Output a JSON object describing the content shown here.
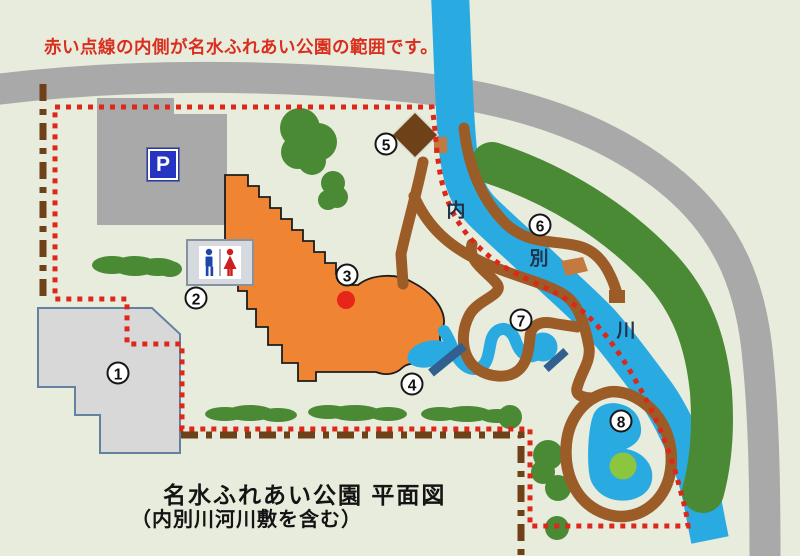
{
  "notice": "赤い点線の内側が名水ふれあい公園の範囲です。",
  "title": {
    "line1": "名水ふれあい公園 平面図",
    "line2": "（内別川河川敷を含む）"
  },
  "parking": {
    "label": "P"
  },
  "river_labels": [
    "内",
    "別",
    "川"
  ],
  "markers": [
    "1",
    "2",
    "3",
    "4",
    "5",
    "6",
    "7",
    "8"
  ],
  "icons": {
    "parking": "parking-sign-icon",
    "toilet_man": "man-icon",
    "toilet_woman": "woman-icon"
  },
  "colors": {
    "background": "#e8ecdd",
    "road_gray": "#a9a9a9",
    "river_blue": "#29abe2",
    "path_brown": "#9c5c28",
    "dock_brown": "#c4793f",
    "diamond_brown": "#6f4119",
    "building_orange": "#ef8532",
    "building1_gray": "#d8d8d8",
    "building1_outline": "#64819f",
    "boundary_red": "#dd2819",
    "dashline_brown": "#6e4118",
    "tree_green": "#4a8a34",
    "island_green": "#8cc63e",
    "bridge_blue": "#31608f",
    "marker_dot_red": "#e8251a",
    "parking_sign_blue": "#2634c4",
    "toilet_man_blue": "#1a47a8",
    "toilet_woman_red": "#cc1f1f"
  }
}
